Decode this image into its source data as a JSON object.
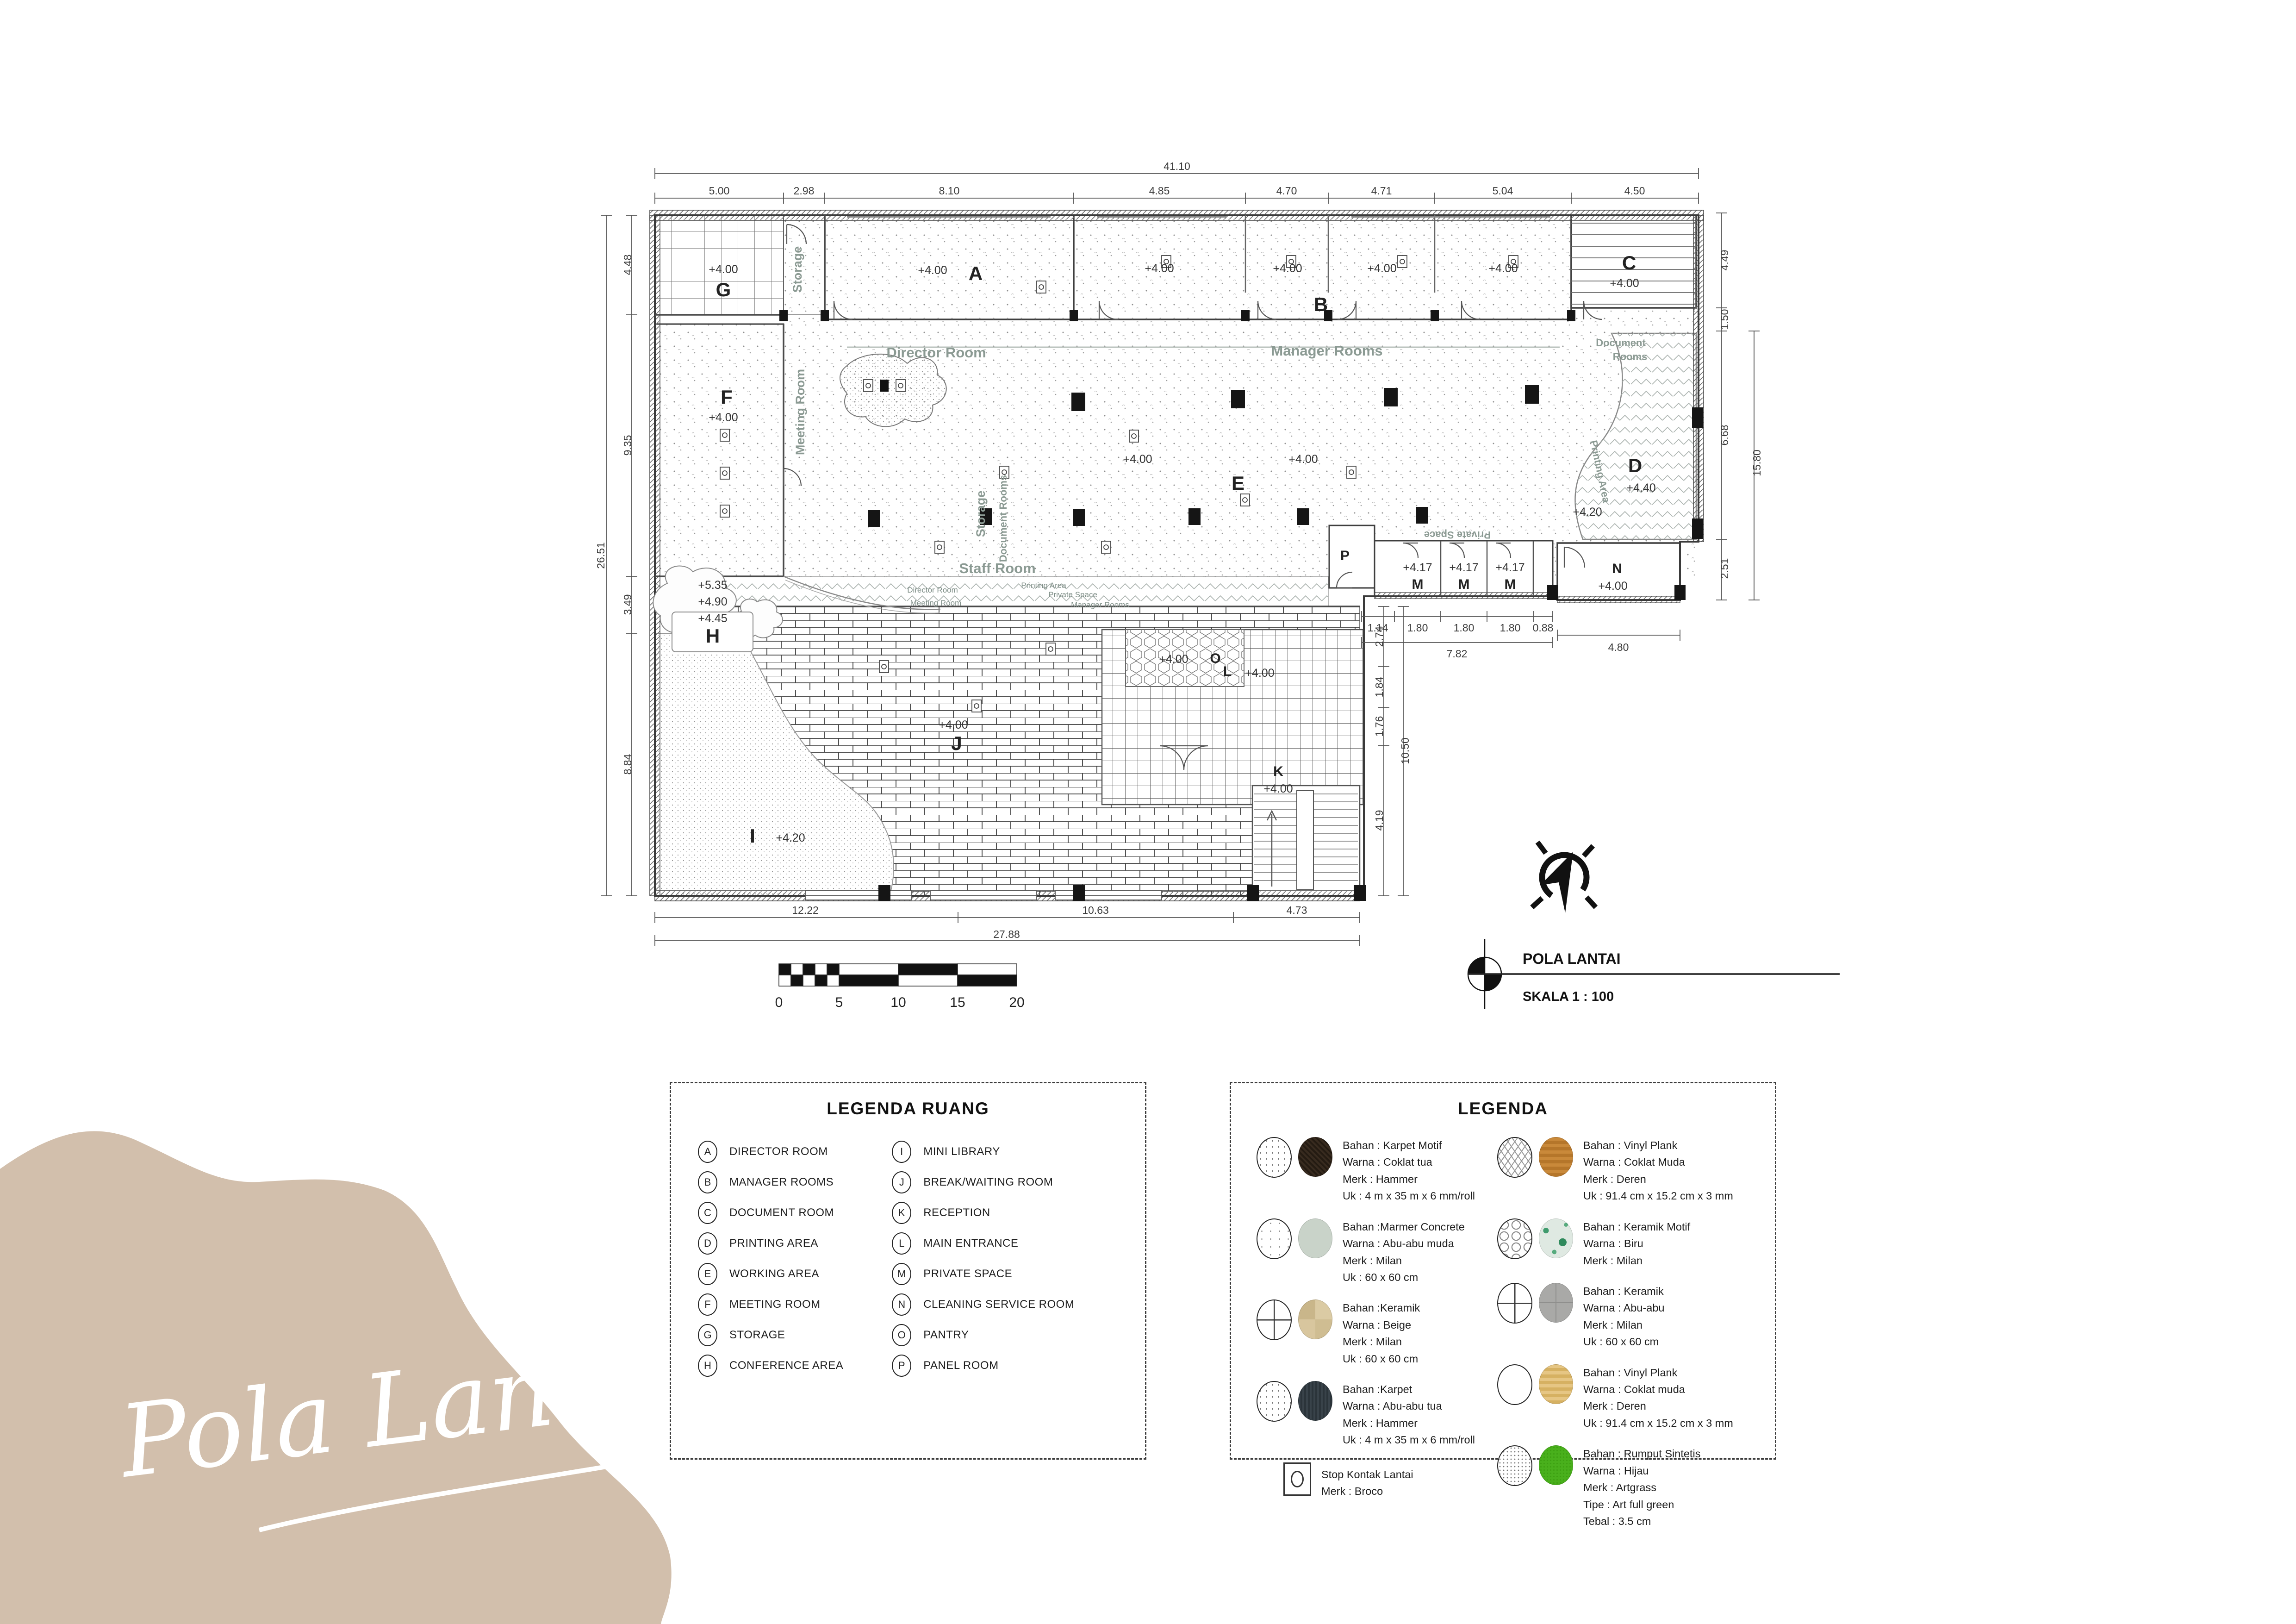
{
  "script_title": "Pola Lantai",
  "title_block": {
    "title": "POLA LANTAI",
    "scale": "SKALA 1 : 100"
  },
  "scale_bar": {
    "ticks": [
      "0",
      "5",
      "10",
      "15",
      "20"
    ]
  },
  "colors": {
    "blob": "#d2bfac",
    "accent_text": "#8b9a93"
  },
  "plan": {
    "dims": {
      "top_total": "41.10",
      "top": [
        "5.00",
        "2.98",
        "8.10",
        "4.85",
        "4.70",
        "4.71",
        "5.04",
        "4.50"
      ],
      "left_total": "26.51",
      "left": [
        "4.48",
        "9.35",
        "3.49",
        "8.84"
      ],
      "right": [
        "4.49",
        "1.50",
        "6.68",
        "2.51"
      ],
      "right_total": "15.80",
      "bottom": [
        "12.22",
        "10.63",
        "4.73"
      ],
      "bottom_total": "27.88",
      "m_row": [
        "1.14",
        "1.80",
        "1.80",
        "1.80",
        "0.88"
      ],
      "m_total": "7.82",
      "n_width": "4.80",
      "inner": [
        "2.74",
        "1.84",
        "1.76",
        "4.19"
      ],
      "inner_total": "10.50"
    },
    "rooms": {
      "g": {
        "letter": "G",
        "level": "+4.00"
      },
      "a": {
        "letter": "A",
        "level": "+4.00"
      },
      "b": {
        "letter": "B",
        "levels": [
          "+4.00",
          "+4.00",
          "+4.00",
          "+4.00"
        ]
      },
      "c": {
        "letter": "C",
        "level": "+4.00"
      },
      "f": {
        "letter": "F",
        "level": "+4.00"
      },
      "e": {
        "letter": "E",
        "level1": "+4.00",
        "level2": "+4.00"
      },
      "d": {
        "letter": "D",
        "level": "+4.40",
        "level2": "+4.20"
      },
      "h": {
        "letter": "H",
        "levels": [
          "+5.35",
          "+4.90",
          "+4.45"
        ]
      },
      "i": {
        "letter": "I",
        "level": "+4.20"
      },
      "j": {
        "letter": "J",
        "level": "+4.00"
      },
      "k": {
        "letter": "K",
        "level": "+4.00"
      },
      "l": {
        "letter": "L",
        "level": "+4.00"
      },
      "o": {
        "letter": "O",
        "level": "+4.00"
      },
      "n": {
        "letter": "N",
        "level": "+4.00"
      },
      "m": {
        "letter": "M",
        "level": "+4.17"
      },
      "p": {
        "letter": "P"
      }
    },
    "labels": {
      "director_room": "Director Room",
      "manager_rooms": "Manager Rooms",
      "document_1": "Document",
      "document_2": "Rooms",
      "staff_room": "Staff Room",
      "storage_top": "Storage",
      "storage_mid": "Storage",
      "meeting_room_v": "Meeting Room",
      "document_rooms_v": "Document Rooms",
      "printing_area": "Printing Area",
      "private_space": "Private Space",
      "sign_director": "Director Room",
      "sign_meeting": "Meeting Room",
      "sign_printing": "Printing Area",
      "sign_private": "Private Space",
      "sign_manager": "Manager Rooms"
    }
  },
  "legend_ruang": {
    "title": "LEGENDA RUANG",
    "items": [
      {
        "letter": "A",
        "label": "DIRECTOR ROOM"
      },
      {
        "letter": "B",
        "label": "MANAGER ROOMS"
      },
      {
        "letter": "C",
        "label": "DOCUMENT ROOM"
      },
      {
        "letter": "D",
        "label": "PRINTING AREA"
      },
      {
        "letter": "E",
        "label": "WORKING AREA"
      },
      {
        "letter": "F",
        "label": "MEETING ROOM"
      },
      {
        "letter": "G",
        "label": "STORAGE"
      },
      {
        "letter": "H",
        "label": "CONFERENCE AREA"
      },
      {
        "letter": "I",
        "label": "MINI LIBRARY"
      },
      {
        "letter": "J",
        "label": "BREAK/WAITING ROOM"
      },
      {
        "letter": "K",
        "label": "RECEPTION"
      },
      {
        "letter": "L",
        "label": "MAIN ENTRANCE"
      },
      {
        "letter": "M",
        "label": "PRIVATE SPACE"
      },
      {
        "letter": "N",
        "label": "CLEANING SERVICE ROOM"
      },
      {
        "letter": "O",
        "label": "PANTRY"
      },
      {
        "letter": "P",
        "label": "PANEL ROOM"
      }
    ]
  },
  "legend_material": {
    "title": "LEGENDA",
    "left": [
      {
        "lines": [
          "Bahan : Karpet Motif",
          "Warna : Coklat tua",
          "Merk : Hammer",
          "Uk : 4 m x 35 m x 6 mm/roll"
        ]
      },
      {
        "lines": [
          "Bahan :Marmer Concrete",
          "Warna : Abu-abu muda",
          "Merk : Milan",
          "Uk : 60 x 60 cm"
        ]
      },
      {
        "lines": [
          "Bahan :Keramik",
          "Warna : Beige",
          "Merk : Milan",
          "Uk : 60 x 60 cm"
        ]
      },
      {
        "lines": [
          "Bahan :Karpet",
          "Warna : Abu-abu tua",
          "Merk : Hammer",
          "Uk : 4 m x 35 m x 6 mm/roll"
        ]
      },
      {
        "lines": [
          "Stop Kontak Lantai",
          "Merk : Broco"
        ]
      }
    ],
    "right": [
      {
        "lines": [
          "Bahan : Vinyl Plank",
          "Warna : Coklat Muda",
          "Merk : Deren",
          "Uk : 91.4 cm x 15.2 cm x 3 mm"
        ]
      },
      {
        "lines": [
          "Bahan : Keramik Motif",
          "Warna : Biru",
          "Merk : Milan"
        ]
      },
      {
        "lines": [
          "Bahan : Keramik",
          "Warna : Abu-abu",
          "Merk : Milan",
          "Uk : 60 x 60 cm"
        ]
      },
      {
        "lines": [
          "Bahan : Vinyl Plank",
          "Warna : Coklat muda",
          "Merk : Deren",
          "Uk : 91.4 cm x 15.2 cm x 3 mm"
        ]
      },
      {
        "lines": [
          "Bahan : Rumput Sintetis",
          "Warna : Hijau",
          "Merk : Artgrass",
          "Tipe : Art full green",
          "Tebal : 3.5 cm"
        ]
      }
    ]
  }
}
